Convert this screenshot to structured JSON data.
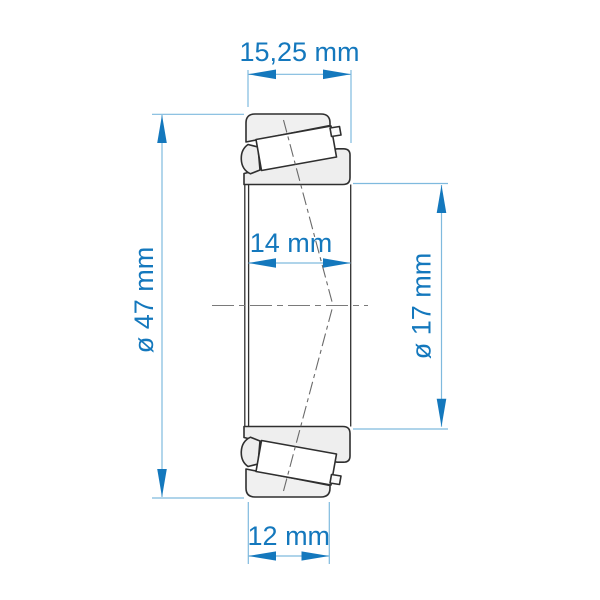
{
  "diagram": {
    "kind": "tapered-roller-bearing-cross-section",
    "dimensions": {
      "total_width": "15,25 mm",
      "inner_ring_width": "14 mm",
      "outer_ring_width": "12 mm",
      "outer_diameter": "ø 47 mm",
      "bore_diameter": "ø 17 mm"
    },
    "colors": {
      "dimension_accent": "#1478bd",
      "extension_line": "#7fbade",
      "outline": "#2f2f2f",
      "ring_fill": "#eeeeee",
      "roller_fill": "#ffffff",
      "background": "#ffffff"
    }
  }
}
